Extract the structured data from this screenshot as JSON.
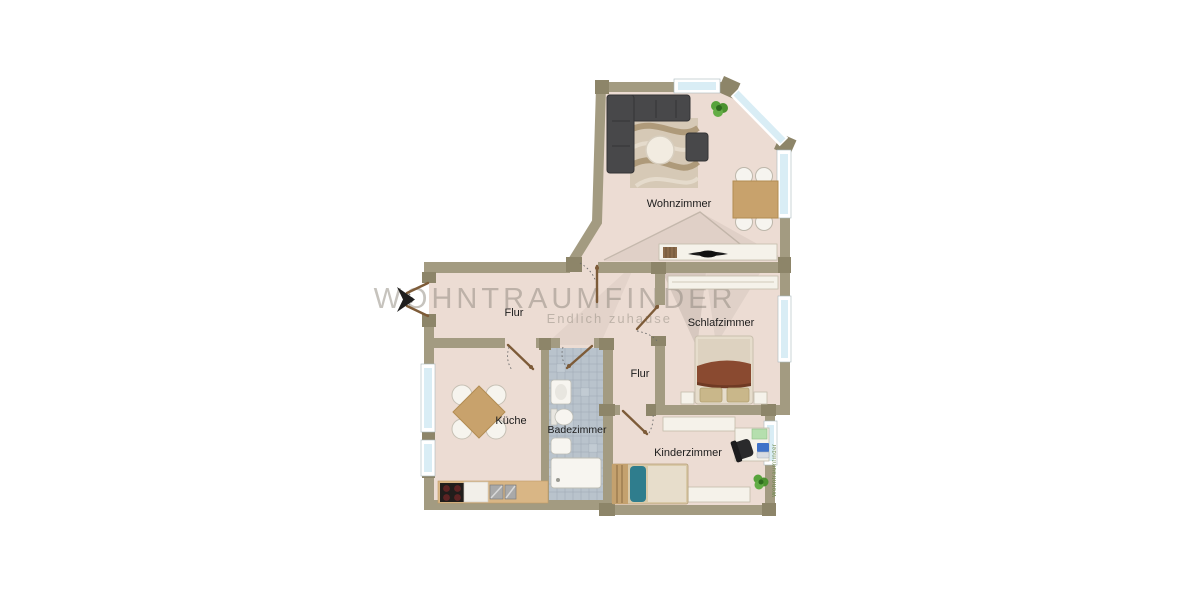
{
  "watermark": {
    "brand": "WOHNTRAUMFINDER",
    "tagline": "Endlich zuhause",
    "side": "Wohntraumfinder"
  },
  "rooms": [
    {
      "id": "wohnzimmer",
      "label": "Wohnzimmer"
    },
    {
      "id": "flur",
      "label": "Flur"
    },
    {
      "id": "schlafzimmer",
      "label": "Schlafzimmer"
    },
    {
      "id": "flur-2",
      "label": "Flur"
    },
    {
      "id": "kueche",
      "label": "Küche"
    },
    {
      "id": "badezimmer",
      "label": "Badezimmer"
    },
    {
      "id": "kinderzimmer",
      "label": "Kinderzimmer"
    }
  ],
  "colors": {
    "floor": "#ecdcd3",
    "wall": "#a39b81",
    "wall_corner": "#8d8569",
    "window_glass": "#d9edf5",
    "bath_tile": "#b9c3cc",
    "sofa": "#48484a",
    "wood": "#c8a26c",
    "bed_blanket": "#8a4a30",
    "kid_blanket": "#2f7d8d",
    "plant": "#57a33b",
    "watermark_text": "#8f887e",
    "entrance_arrow": "#1e1e1e"
  }
}
